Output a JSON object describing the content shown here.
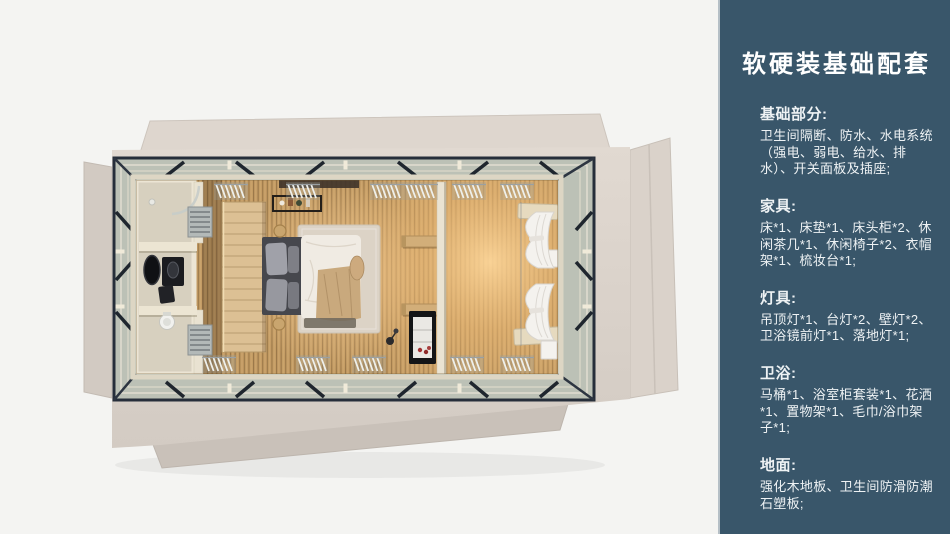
{
  "panel": {
    "title": "软硬装基础配套",
    "sections": [
      {
        "heading": "基础部分:",
        "body": "卫生间隔断、防水、水电系统（强电、弱电、给水、排水）、开关面板及插座;"
      },
      {
        "heading": "家具:",
        "body": "床*1、床垫*1、床头柜*2、休闲茶几*1、休闲椅子*2、衣帽架*1、梳妆台*1;"
      },
      {
        "heading": "灯具:",
        "body": "吊顶灯*1、台灯*2、壁灯*2、卫浴镜前灯*1、落地灯*1;"
      },
      {
        "heading": "卫浴:",
        "body": "马桶*1、浴室柜套装*1、花洒*1、置物架*1、毛巾/浴巾架子*1;"
      },
      {
        "heading": "地面:",
        "body": "强化木地板、卫生间防滑防潮石塑板;"
      }
    ]
  },
  "colors": {
    "canvas_bg": "#f4f4f2",
    "panel_bg": "#39566a",
    "panel_edge": "#b5bfc6",
    "panel_text": "#eef2f4",
    "shell_beige": "#dbd3cb",
    "steel_frame": "#262e3a",
    "deck_gray": "#bcc1b6",
    "wood_floor": "#c49c64",
    "warm_glow": "#f2c584"
  }
}
